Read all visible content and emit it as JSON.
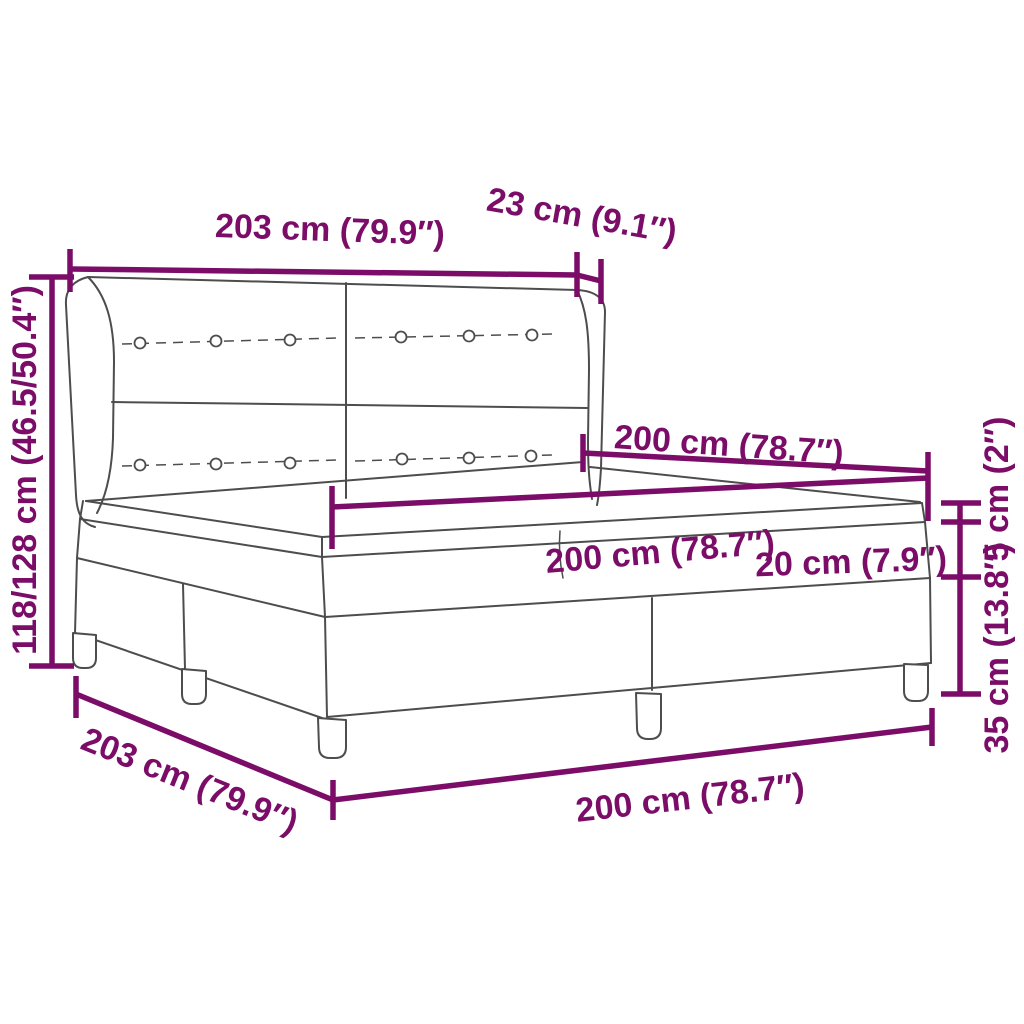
{
  "diagram": {
    "kind": "product-dimension-diagram",
    "product": "box spring bed with winged button-tufted headboard, two-piece base, mattress and topper",
    "colors": {
      "dimension": "#7B0D69",
      "outline": "#4D4D4D",
      "background": "#FFFFFF"
    },
    "labels": {
      "headboard_width": "203 cm (79.9″)",
      "headboard_depth": "23 cm (9.1″)",
      "total_height": "118/128 cm (46.5/50.4″)",
      "bed_length": "200 cm (78.7″)",
      "mattress_width": "200 cm (78.7″)",
      "mattress_height": "20 cm (7.9″)",
      "topper_height": "5 cm (2″)",
      "base_height": "35 cm (13.8″)",
      "frame_width_bottom": "203 cm (79.9″)",
      "frame_length_bottom": "200 cm (78.7″)"
    }
  }
}
